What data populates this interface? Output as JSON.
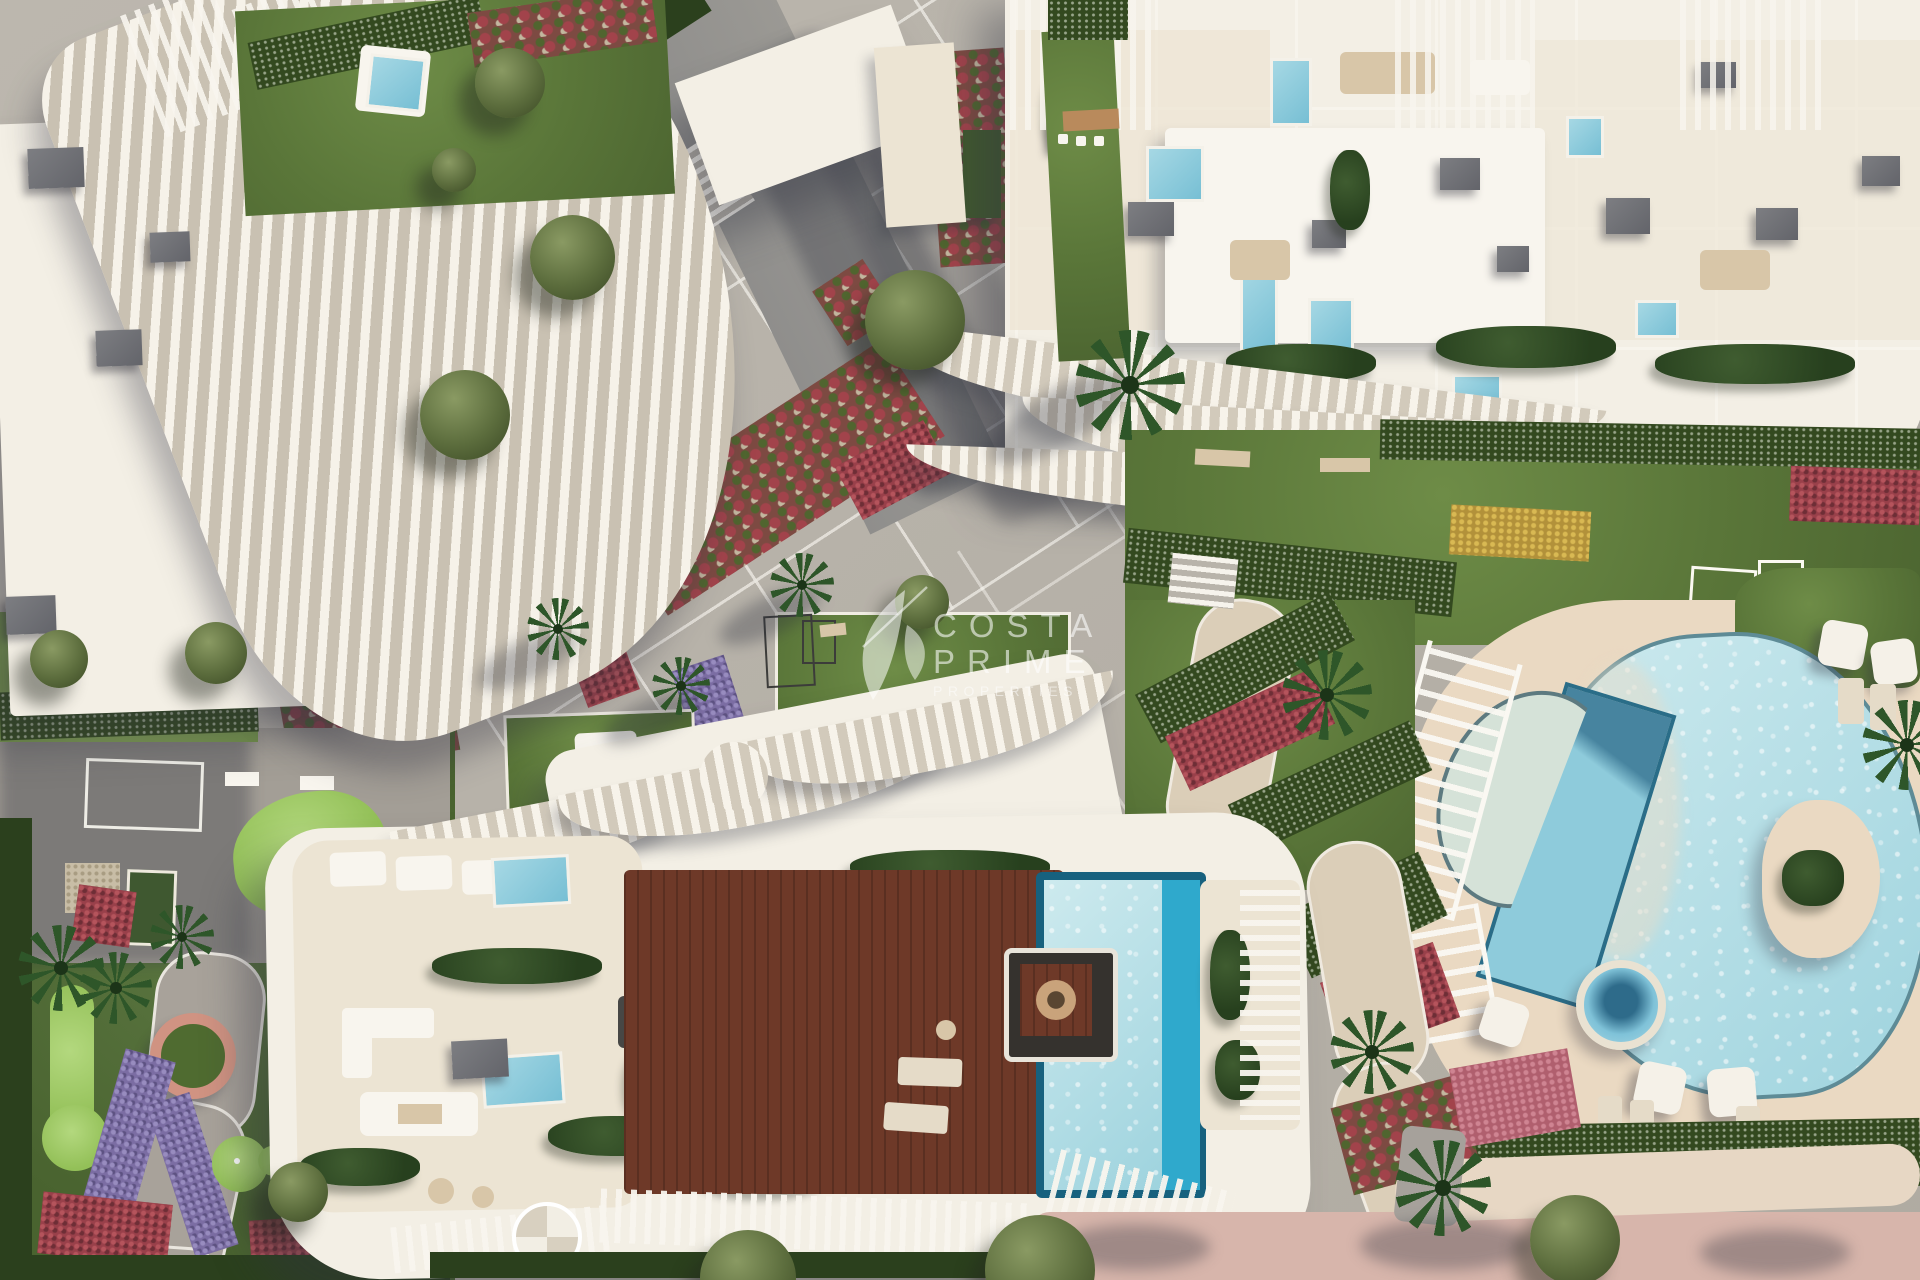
{
  "watermark": {
    "word1": "COSTA",
    "word2": "PRIME",
    "word3": "PROPERTIES",
    "logo_icon": "hummingbird-leaves-logo",
    "color": "rgba(255,255,255,0.58)"
  },
  "palette": {
    "paving": "#b6b1a8",
    "plaza_line": "#f8f5ee",
    "roof_white": "#f3efe5",
    "terrace_cream": "#ece4d3",
    "lawn": "#5a7639",
    "hedge_dark": "#33491f",
    "golf_green": "#93c058",
    "pool_pale": "#cdeaee",
    "pool_mid": "#77bfd4",
    "pool_edge_cyan": "#2fa9cc",
    "pool_rim_dark": "#17617e",
    "deck_wood": "#6e3928",
    "pool_deck_sand": "#ead9c2",
    "flowers_red": "#99404a",
    "flowers_purple": "#7b6da3",
    "flowers_yellow": "#b2913a",
    "beach_path_pink": "#d7b5ab",
    "road_dark": "#8f8e8c"
  },
  "scene": {
    "type": "architectural-aerial-render"
  }
}
